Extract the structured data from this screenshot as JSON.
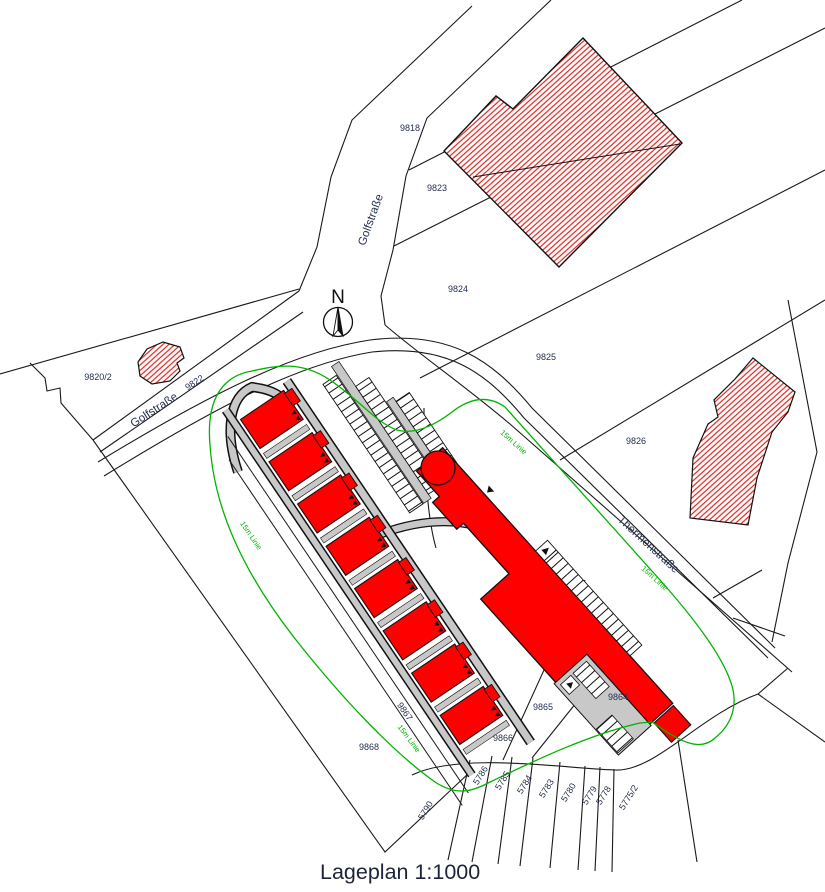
{
  "caption": "Lageplan 1:1000",
  "compass": {
    "label": "N"
  },
  "streets": {
    "golfstrasse": "Golfstraße",
    "thermenstrasse": "Thermenstraße"
  },
  "setback": {
    "label": "15m Linie",
    "color": "#00b400"
  },
  "parcels": {
    "p9818": "9818",
    "p9823": "9823",
    "p9824": "9824",
    "p9825": "9825",
    "p9826": "9826",
    "p9820_2": "9820/2",
    "p9822": "9822",
    "p9868": "9868",
    "p9867": "9867",
    "p9866": "9866",
    "p9865": "9865",
    "p9864": "9864",
    "p5790": "5790",
    "p5786": "5786",
    "p5785": "5785",
    "p5784": "5784",
    "p5783": "5783",
    "p5780": "5780",
    "p5779": "5779",
    "p5778": "5778",
    "p5775_2": "5775/2"
  },
  "colors": {
    "new_building": "#ff0000",
    "existing_building_hatch": "#e0251f",
    "road": "#c8c8c8",
    "boundary": "#1a1a1a",
    "setback_line": "#00b400",
    "label_text": "#25304f"
  }
}
